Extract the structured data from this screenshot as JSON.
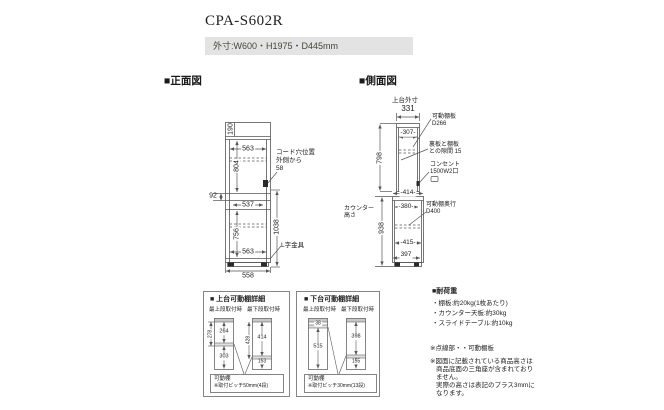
{
  "colors": {
    "background": "#ffffff",
    "line": "#555555",
    "text": "#222222",
    "dims_box_bg": "#e3e3e3"
  },
  "header": {
    "title": "CPA-S602R",
    "outer_size": "外寸:W600・H1975・D445mm"
  },
  "front_view": {
    "label": "■正面図",
    "dim_190": "190",
    "dim_563_top": "563",
    "dim_804": "804",
    "dim_92": "92",
    "dim_537": "537",
    "dim_1038": "1038",
    "dim_756": "756",
    "dim_563_bottom": "563",
    "dim_558": "558",
    "cord_note_line1": "コード穴位置",
    "cord_note_line2": "外側から",
    "cord_note_line3": "58",
    "bracket_note": "L字金具"
  },
  "side_view": {
    "label": "■側面図",
    "upper_outer_label": "上台外寸",
    "dim_331": "331",
    "dim_307": "-307-",
    "dim_798": "798",
    "dim_414": "-414-",
    "dim_380": "-380-",
    "counter_label_line1": "カウンター",
    "counter_label_line2": "高さ",
    "dim_938": "938",
    "dim_415": "-415-",
    "dim_397": "397",
    "shelf_note_line1": "可動棚板",
    "shelf_note_line2": "D266",
    "gap_note_line1": "裏板と棚板",
    "gap_note_line2": "との隙間 15",
    "outlet_note_line1": "コンセント",
    "outlet_note_line2": "1500W2口",
    "depth_note_line1": "可動棚奥行",
    "depth_note_line2": "D400"
  },
  "upper_shelf_detail": {
    "title": "■ 上台可動棚詳細",
    "left_label": "最上段取付時",
    "right_label": "最下段取付時",
    "left_outer": "278",
    "left_top": "264",
    "left_bottom": "303",
    "right_outer": "428",
    "right_top": "414",
    "right_bottom": "153",
    "note_line1": "可動棚",
    "note_line2": "※取付ピッチ50mm(4段)"
  },
  "lower_shelf_detail": {
    "title": "■ 下台可動棚詳細",
    "left_label": "最上段取付時",
    "right_label": "最下段取付時",
    "left_top": "38",
    "left_bottom": "515",
    "right_top": "398",
    "right_bottom": "155",
    "note_line1": "可動棚",
    "note_line2": "※取付ピッチ30mm(13段)"
  },
  "load_notes": {
    "title": "■耐荷重",
    "items": [
      "・棚板:約20kg(1枚あたり)",
      "・カウンター天板:約30kg",
      "・スライドテーブル:約10kg"
    ],
    "triangle_note": "※点線部・・可動棚板",
    "height_note_line1": "※図面に記載されている商品高さは",
    "height_note_line2": "商品底面の三角座が含まれており",
    "height_note_line3": "ません。",
    "height_note_line4": "実際の高さは表記のプラス3mmに",
    "height_note_line5": "なります。"
  }
}
